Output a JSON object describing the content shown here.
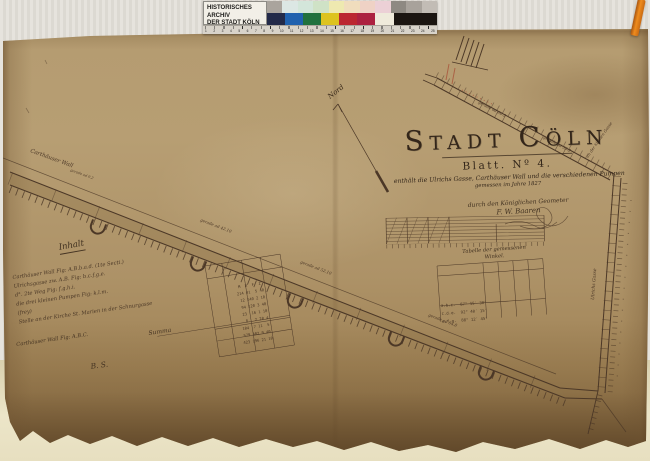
{
  "archive_label": {
    "line1": "HISTORISCHES ARCHIV",
    "line2": "DER STADT KÖLN"
  },
  "calibration": {
    "patches_top": [
      "#aaa49d",
      "#dce7e4",
      "#d3e6da",
      "#cfe2c6",
      "#eee9b0",
      "#f0ddbd",
      "#efd2c5",
      "#ecd0d6",
      "#8e8982",
      "#a8a29b",
      "#c2bcb5"
    ],
    "patches_bottom": [
      "#232a49",
      "#2061ae",
      "#20713e",
      "#ddc31f",
      "#bb2731",
      "#ac2140",
      "#efeadb",
      "#1b1511"
    ],
    "ruler_numbers": [
      "1",
      "2",
      "3",
      "4",
      "5",
      "6",
      "7",
      "8",
      "9",
      "10",
      "11",
      "12",
      "13",
      "14",
      "15",
      "16",
      "17",
      "18",
      "19",
      "20",
      "21",
      "22",
      "23",
      "24",
      "25"
    ]
  },
  "map": {
    "title_word1": "Stadt",
    "title_word2": "Cöln",
    "sheet_label": "Blatt. Nº 4.",
    "subtitle": "enthält die Ulrichs Gasse, Carthäuser Wall und die verschiedenen Pumpen",
    "subtitle2": "gemessen im Jahre 1827",
    "credit": "durch den Königlichen Geometer",
    "signature": "F. W. Baaren",
    "north_label": "Nord",
    "labels": {
      "wall": "Carthäuser Wall",
      "wall_m0": "gerade ad 9.2",
      "wall_m1": "gerade ad 42.10",
      "wall_m2": "gerade ad 52.10",
      "wall_m3": "gerade ad 64.8",
      "street_m1": "gerade ad 80.5",
      "street_m2": "gerade ad 35.2",
      "street_side": "an der kleinen Gasse",
      "street_v": "Ulrichs Gasse"
    },
    "inhalt": {
      "heading": "Inhalt",
      "rows": [
        "Carthäuser Wall Fig: A.B.b.a.d. (1te Secti.)",
        "Ulrichsgasse zw. A.B. Fig: b.c.f.g.e.",
        "d°. 2te Weg Fig: f.g.h.i.",
        "die drei kleinen Pumpen Fig: k.l.m.",
        "(frey)",
        "Stelle an der Kirche St. Marien in der Schnurgasse"
      ],
      "summa_label": "Summa",
      "extra_row": "Carthäuser Wall Fig: A.B.C.",
      "sign": "B. S.",
      "grid_rows": [
        "M  R  F  Z",
        "214 41  5 40",
        " 12 140 2 10",
        " 94 120 3 40",
        " 23  16 1 10",
        "  8   2 20 4",
        "104  7 11  5",
        "",
        "579 402 9 40",
        "423 196 21 10"
      ]
    },
    "angle_table": {
      "heading1": "Tabelle der gemessenen",
      "heading2": "Winkel.",
      "rows": [
        "a.b.c.  87° 15′ 30″",
        "c.d.e.  92° 40′ 15″",
        "e.f.g.  88° 12′ 45″"
      ]
    }
  }
}
